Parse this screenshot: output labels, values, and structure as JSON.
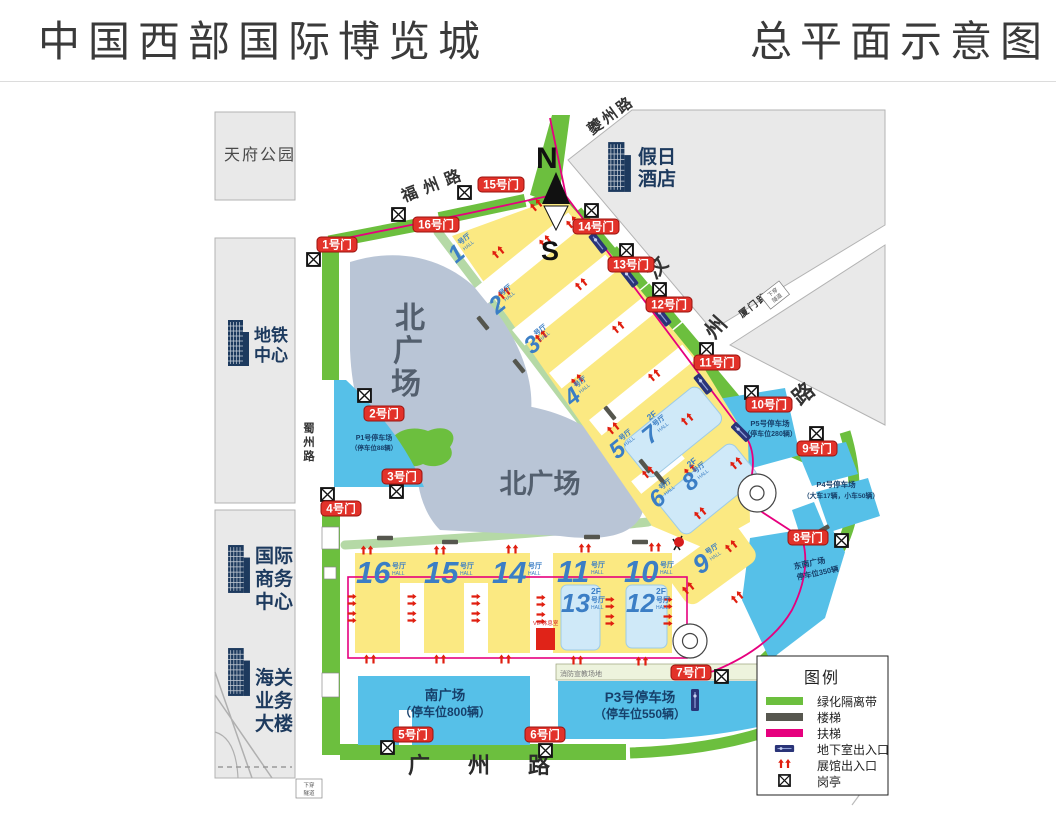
{
  "header": {
    "title": "中国西部国际博览城",
    "subtitle": "总平面示意图"
  },
  "landmarks": {
    "tianfu_park": "天府公园",
    "metro": {
      "lines": [
        "地铁",
        "中心"
      ]
    },
    "business": {
      "lines": [
        "国际",
        "商务",
        "中心"
      ]
    },
    "customs": {
      "lines": [
        "海关",
        "业务",
        "大楼"
      ]
    },
    "hotel": {
      "lines": [
        "假日",
        "酒店"
      ]
    }
  },
  "roads": {
    "fuzhou": "福州路",
    "kuizhou": "夔州路",
    "wenzhou": [
      "汶",
      "州",
      "路"
    ],
    "xiamen": "厦门路",
    "shuzhou": [
      "蜀",
      "州",
      "路"
    ],
    "guangzhou": "广州路",
    "tunnel": [
      "下穿",
      "隧道"
    ]
  },
  "compass": {
    "n": "N",
    "s": "S"
  },
  "gates": {
    "g1": "1号门",
    "g2": "2号门",
    "g3": "3号门",
    "g4": "4号门",
    "g5": "5号门",
    "g6": "6号门",
    "g7": "7号门",
    "g8": "8号门",
    "g9": "9号门",
    "g10": "10号门",
    "g11": "11号门",
    "g12": "12号门",
    "g13": "13号门",
    "g14": "14号门",
    "g15": "15号门",
    "g16": "16号门"
  },
  "halls": {
    "h1": {
      "num": "1",
      "suffix": "号厅",
      "sub": "HALL"
    },
    "h2": {
      "num": "2",
      "suffix": "号厅",
      "sub": "HALL"
    },
    "h3": {
      "num": "3",
      "suffix": "号厅",
      "sub": "HALL"
    },
    "h4": {
      "num": "4",
      "suffix": "号厅",
      "sub": "HALL"
    },
    "h5": {
      "num": "5",
      "suffix": "号厅",
      "sub": "HALL"
    },
    "h6": {
      "num": "6",
      "suffix": "号厅",
      "sub": "HALL"
    },
    "h7": {
      "num": "7",
      "fl": "2F",
      "suffix": "号厅",
      "sub": "HALL"
    },
    "h8": {
      "num": "8",
      "fl": "2F",
      "suffix": "号厅",
      "sub": "HALL"
    },
    "h9": {
      "num": "9",
      "suffix": "号厅",
      "sub": "HALL"
    },
    "h10": {
      "num": "10",
      "suffix": "号厅",
      "sub": "HALL"
    },
    "h11": {
      "num": "11",
      "suffix": "号厅",
      "sub": "HALL"
    },
    "h12": {
      "num": "12",
      "fl": "2F",
      "suffix": "号厅",
      "sub": "HALL"
    },
    "h13": {
      "num": "13",
      "fl": "2F",
      "suffix": "号厅",
      "sub": "HALL"
    },
    "h14": {
      "num": "14",
      "suffix": "号厅",
      "sub": "HALL"
    },
    "h15": {
      "num": "15",
      "suffix": "号厅",
      "sub": "HALL"
    },
    "h16": {
      "num": "16",
      "suffix": "号厅",
      "sub": "HALL"
    }
  },
  "plazas": {
    "north": {
      "chars": [
        "北",
        "广",
        "场"
      ],
      "text": "北广场"
    },
    "south": {
      "name": "南广场",
      "capacity": "（停车位800辆）"
    },
    "southeast": {
      "name": "东南广场",
      "capacity": "停车位350辆"
    }
  },
  "parking": {
    "p1": {
      "name": "P1号停车场",
      "capacity": "（停车位88辆）"
    },
    "p3": {
      "name": "P3号停车场",
      "capacity": "（停车位550辆）"
    },
    "p4": {
      "name": "P4号停车场",
      "capacity": "（大车17辆，小车50辆）"
    },
    "p5": {
      "name": "P5号停车场",
      "capacity": "（停车位280辆）"
    }
  },
  "labels": {
    "fire": "消防宣教场地",
    "vip": "VIP休息室"
  },
  "legend": {
    "title": "图例",
    "items": [
      "绿化隔离带",
      "楼梯",
      "扶梯",
      "地下室出入口",
      "展馆出入口",
      "岗亭"
    ]
  },
  "colors": {
    "greenbelt": "#6cbf3e",
    "stairs": "#55564e",
    "escalator": "#e6007e",
    "basement": "#2a3478",
    "hall_entrance": "#e01f10",
    "gate": "#e2322a",
    "hall": "#fbe982",
    "hall_2f": "#cfe9f8",
    "parking": "#56c0e8",
    "plaza": "#b9c5d6"
  }
}
